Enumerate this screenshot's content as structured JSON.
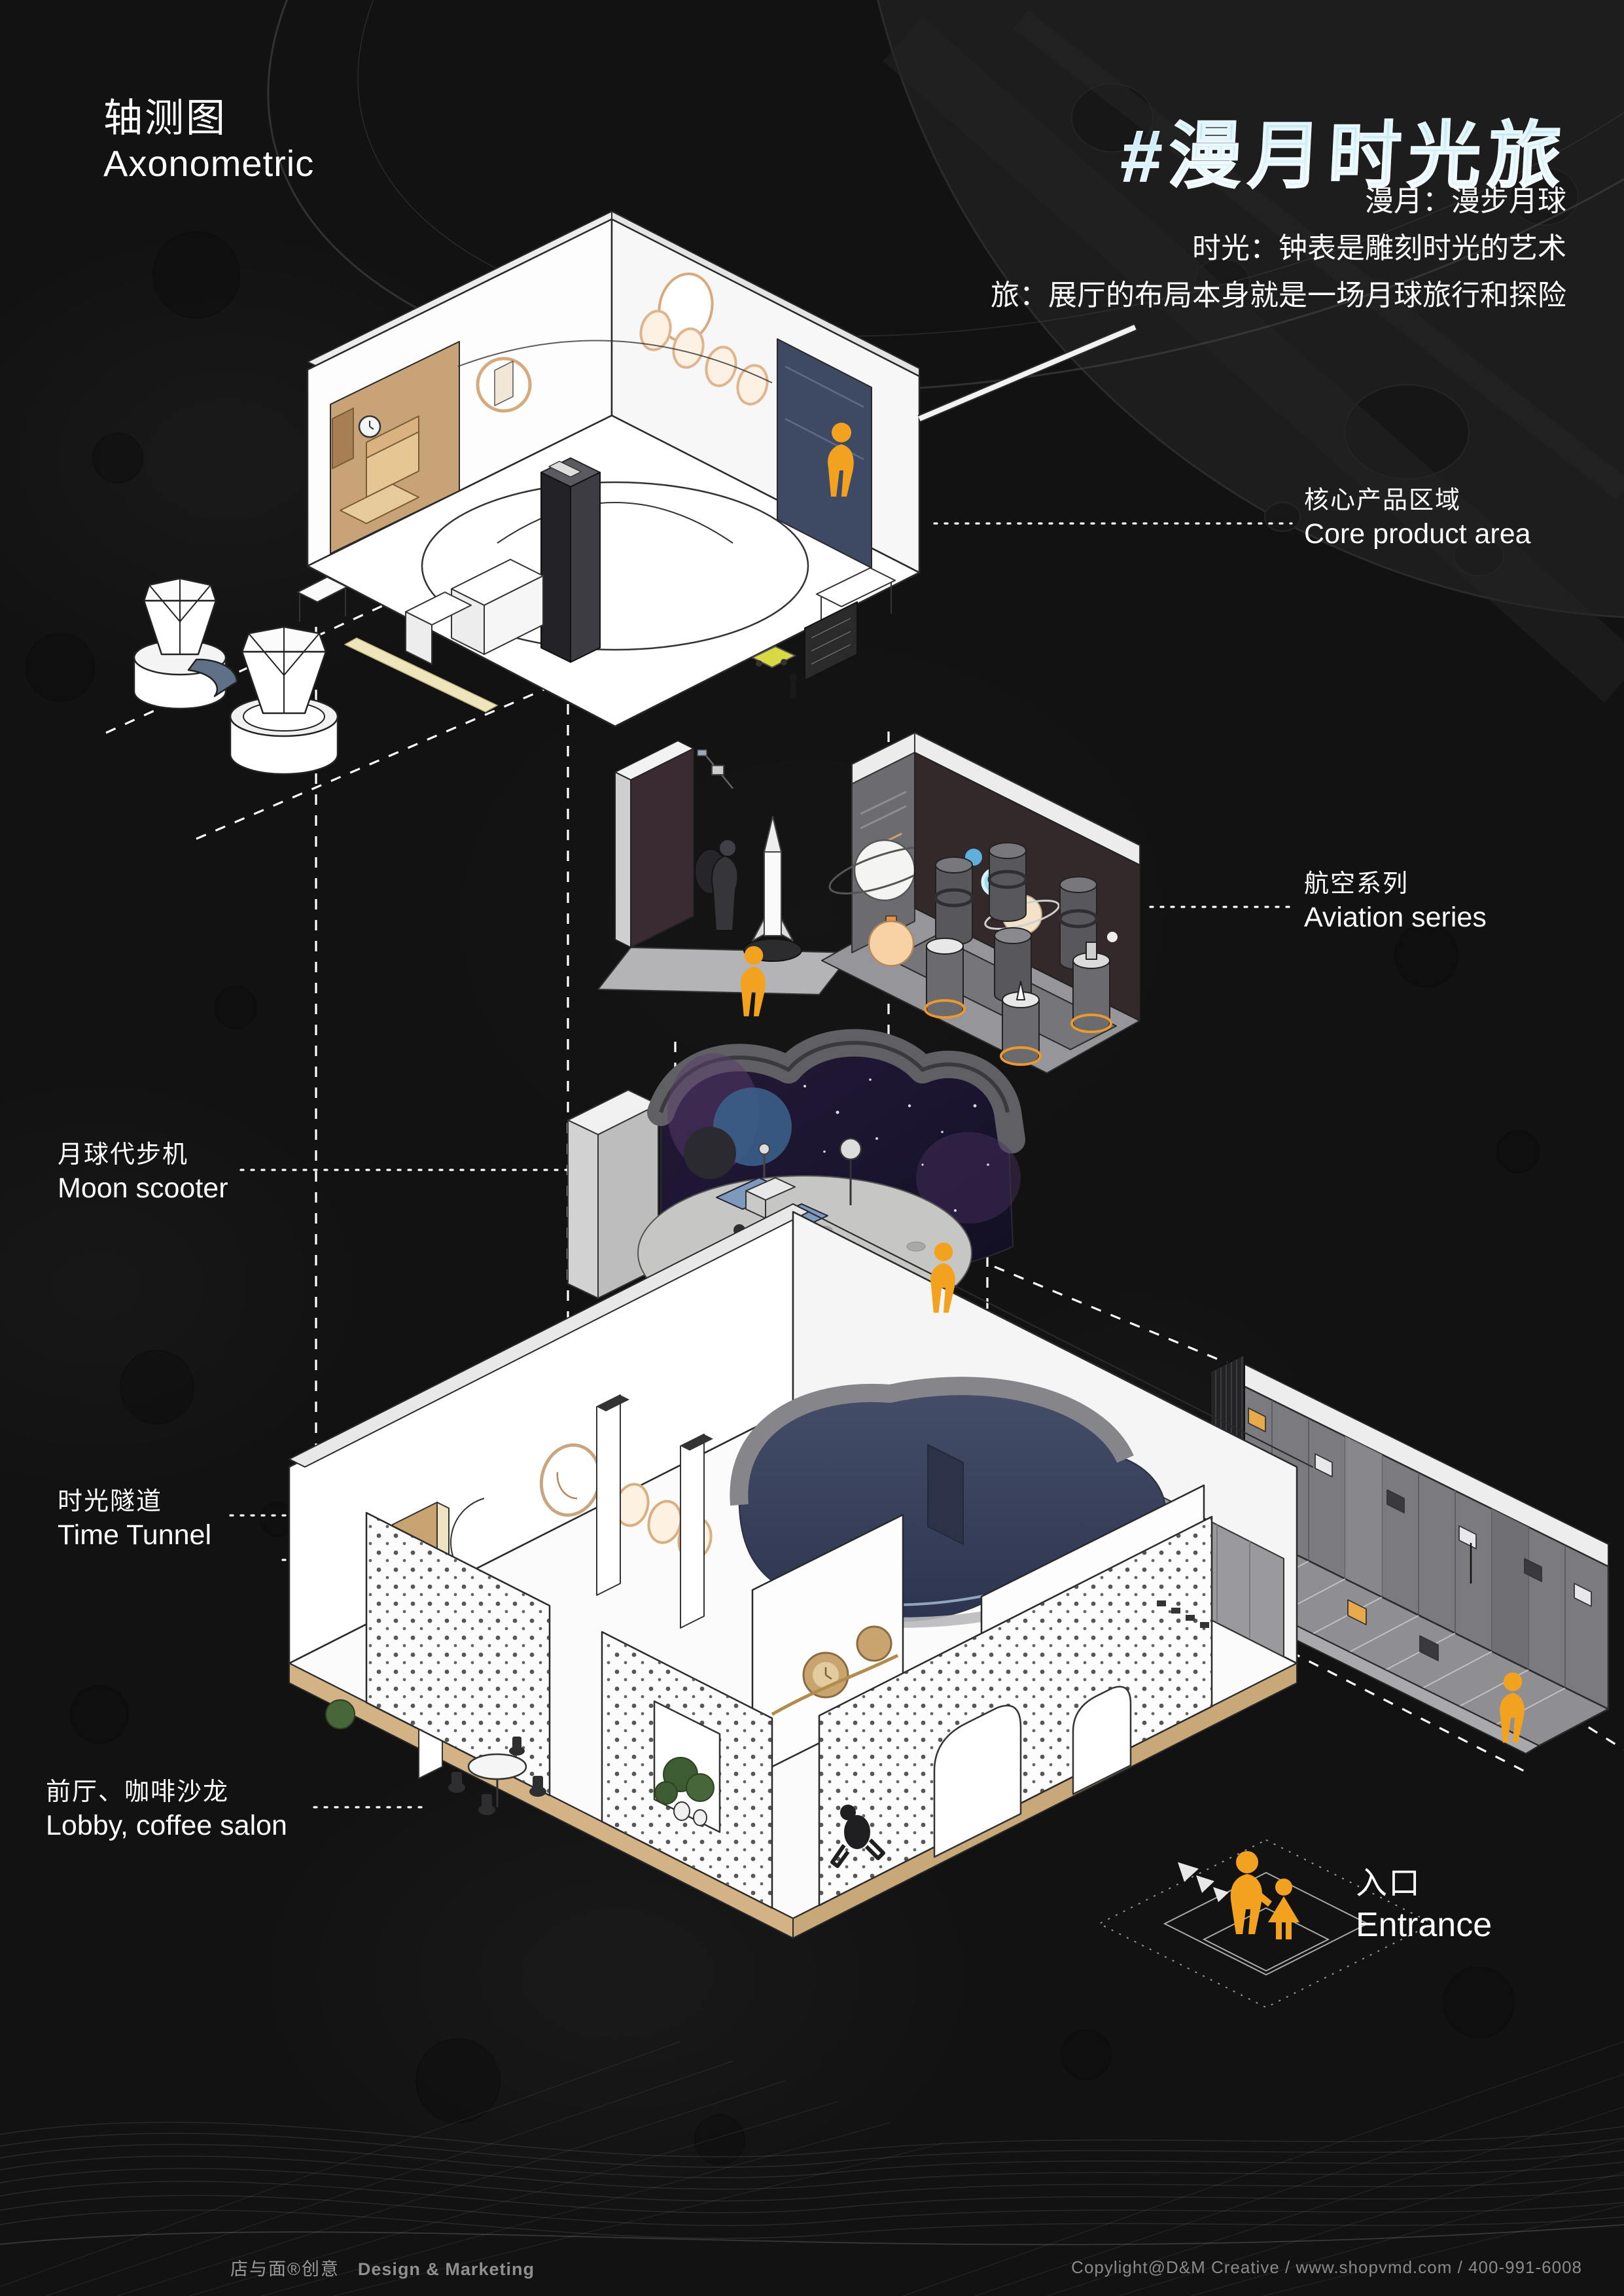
{
  "header": {
    "section_title_cn": "轴测图",
    "section_title_en": "Axonometric",
    "main_title": "#漫月时光旅",
    "subtitles": [
      "漫月：漫步月球",
      "时光：钟表是雕刻时光的艺术",
      "旅：展厅的布局本身就是一场月球旅行和探险"
    ]
  },
  "annotations": {
    "core_product_area": {
      "cn": "核心产品区域",
      "en": "Core product area"
    },
    "aviation_series": {
      "cn": "航空系列",
      "en": "Aviation series"
    },
    "moon_scooter": {
      "cn": "月球代步机",
      "en": "Moon scooter"
    },
    "time_tunnel": {
      "cn": "时光隧道",
      "en": "Time Tunnel"
    },
    "lobby_coffee_salon": {
      "cn": "前厅、咖啡沙龙",
      "en": "Lobby, coffee salon"
    },
    "entrance": {
      "cn": "入口",
      "en": "Entrance"
    }
  },
  "icons": {
    "visitor": "person-icon",
    "entrance_family": "family-icon",
    "entrance_arrows": "direction-arrows-icon"
  },
  "footer": {
    "brand": "店与面®创意",
    "brand_en": "Design & Marketing",
    "copyright": "Copylight@D&M Creative / www.shopvmd.com / 400-991-6008"
  },
  "colors": {
    "background": "#121212",
    "accent_orange": "#F2A21E",
    "title_blue": "#BFE6F2",
    "navy_panel": "#3E4A63",
    "wood_tan": "#D2B183",
    "text_white": "#FFFFFF",
    "footer_gray": "#9A9A9A"
  }
}
